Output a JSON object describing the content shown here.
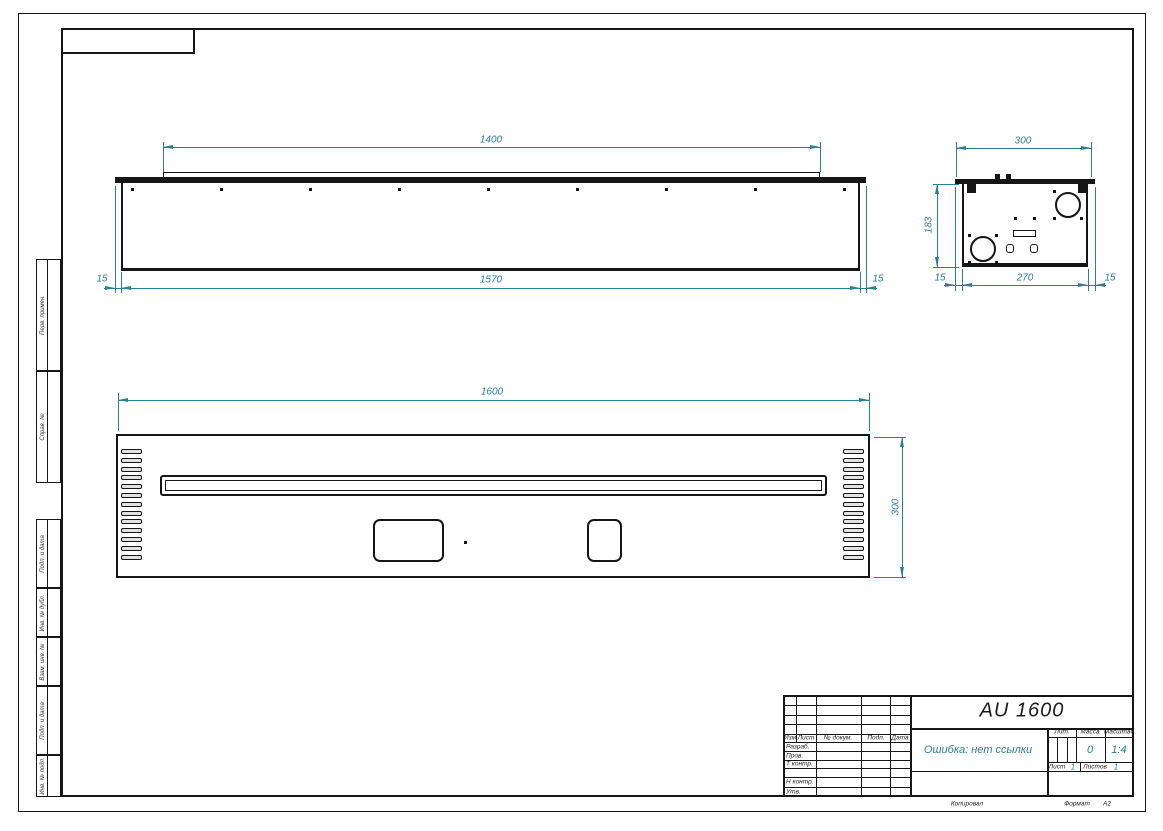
{
  "title_block": {
    "designation": "AU 1600",
    "doc_name": "Ошибка: нет ссылки",
    "header_cols": [
      "Изм",
      "Лист",
      "№ докум.",
      "Подп.",
      "Дата"
    ],
    "rows": {
      "developed": "Разраб.",
      "checked": "Пров.",
      "tcontrol": "Т контр.",
      "ncontrol": "Н контр.",
      "approved": "Утв."
    },
    "lit_label": "Лит.",
    "mass_label": "Масса",
    "scale_label": "Масштаб",
    "mass_value": "0",
    "scale_value": "1:4",
    "sheet_label": "Лист",
    "sheet_value": "1",
    "sheets_label": "Листов",
    "sheets_value": "1",
    "copied_label": "Копировал",
    "format_label": "Формат",
    "format_value": "А2"
  },
  "margin": {
    "labels_upper": [
      "Перв. примен.",
      "Справ. №"
    ],
    "labels_lower": [
      "Подп. и дата",
      "Инв. № дубл.",
      "Взам. инв. №",
      "Подп. и дата",
      "Инв. № подл."
    ]
  },
  "views": {
    "top_view": {
      "dim_flange": "1400",
      "dim_body": "1570",
      "dim_side_left": "15",
      "dim_side_right": "15",
      "hole_count": 9
    },
    "front_view": {
      "dim_width": "1600",
      "dim_height": "300",
      "vent_count_per_side": 13
    },
    "side_view": {
      "dim_width": "300",
      "dim_height": "183",
      "dim_body": "270",
      "dim_side_left": "15",
      "dim_side_right": "15"
    }
  },
  "colors": {
    "dimension_color": "#2a7f91",
    "line_color": "#161616",
    "background": "#ffffff"
  }
}
